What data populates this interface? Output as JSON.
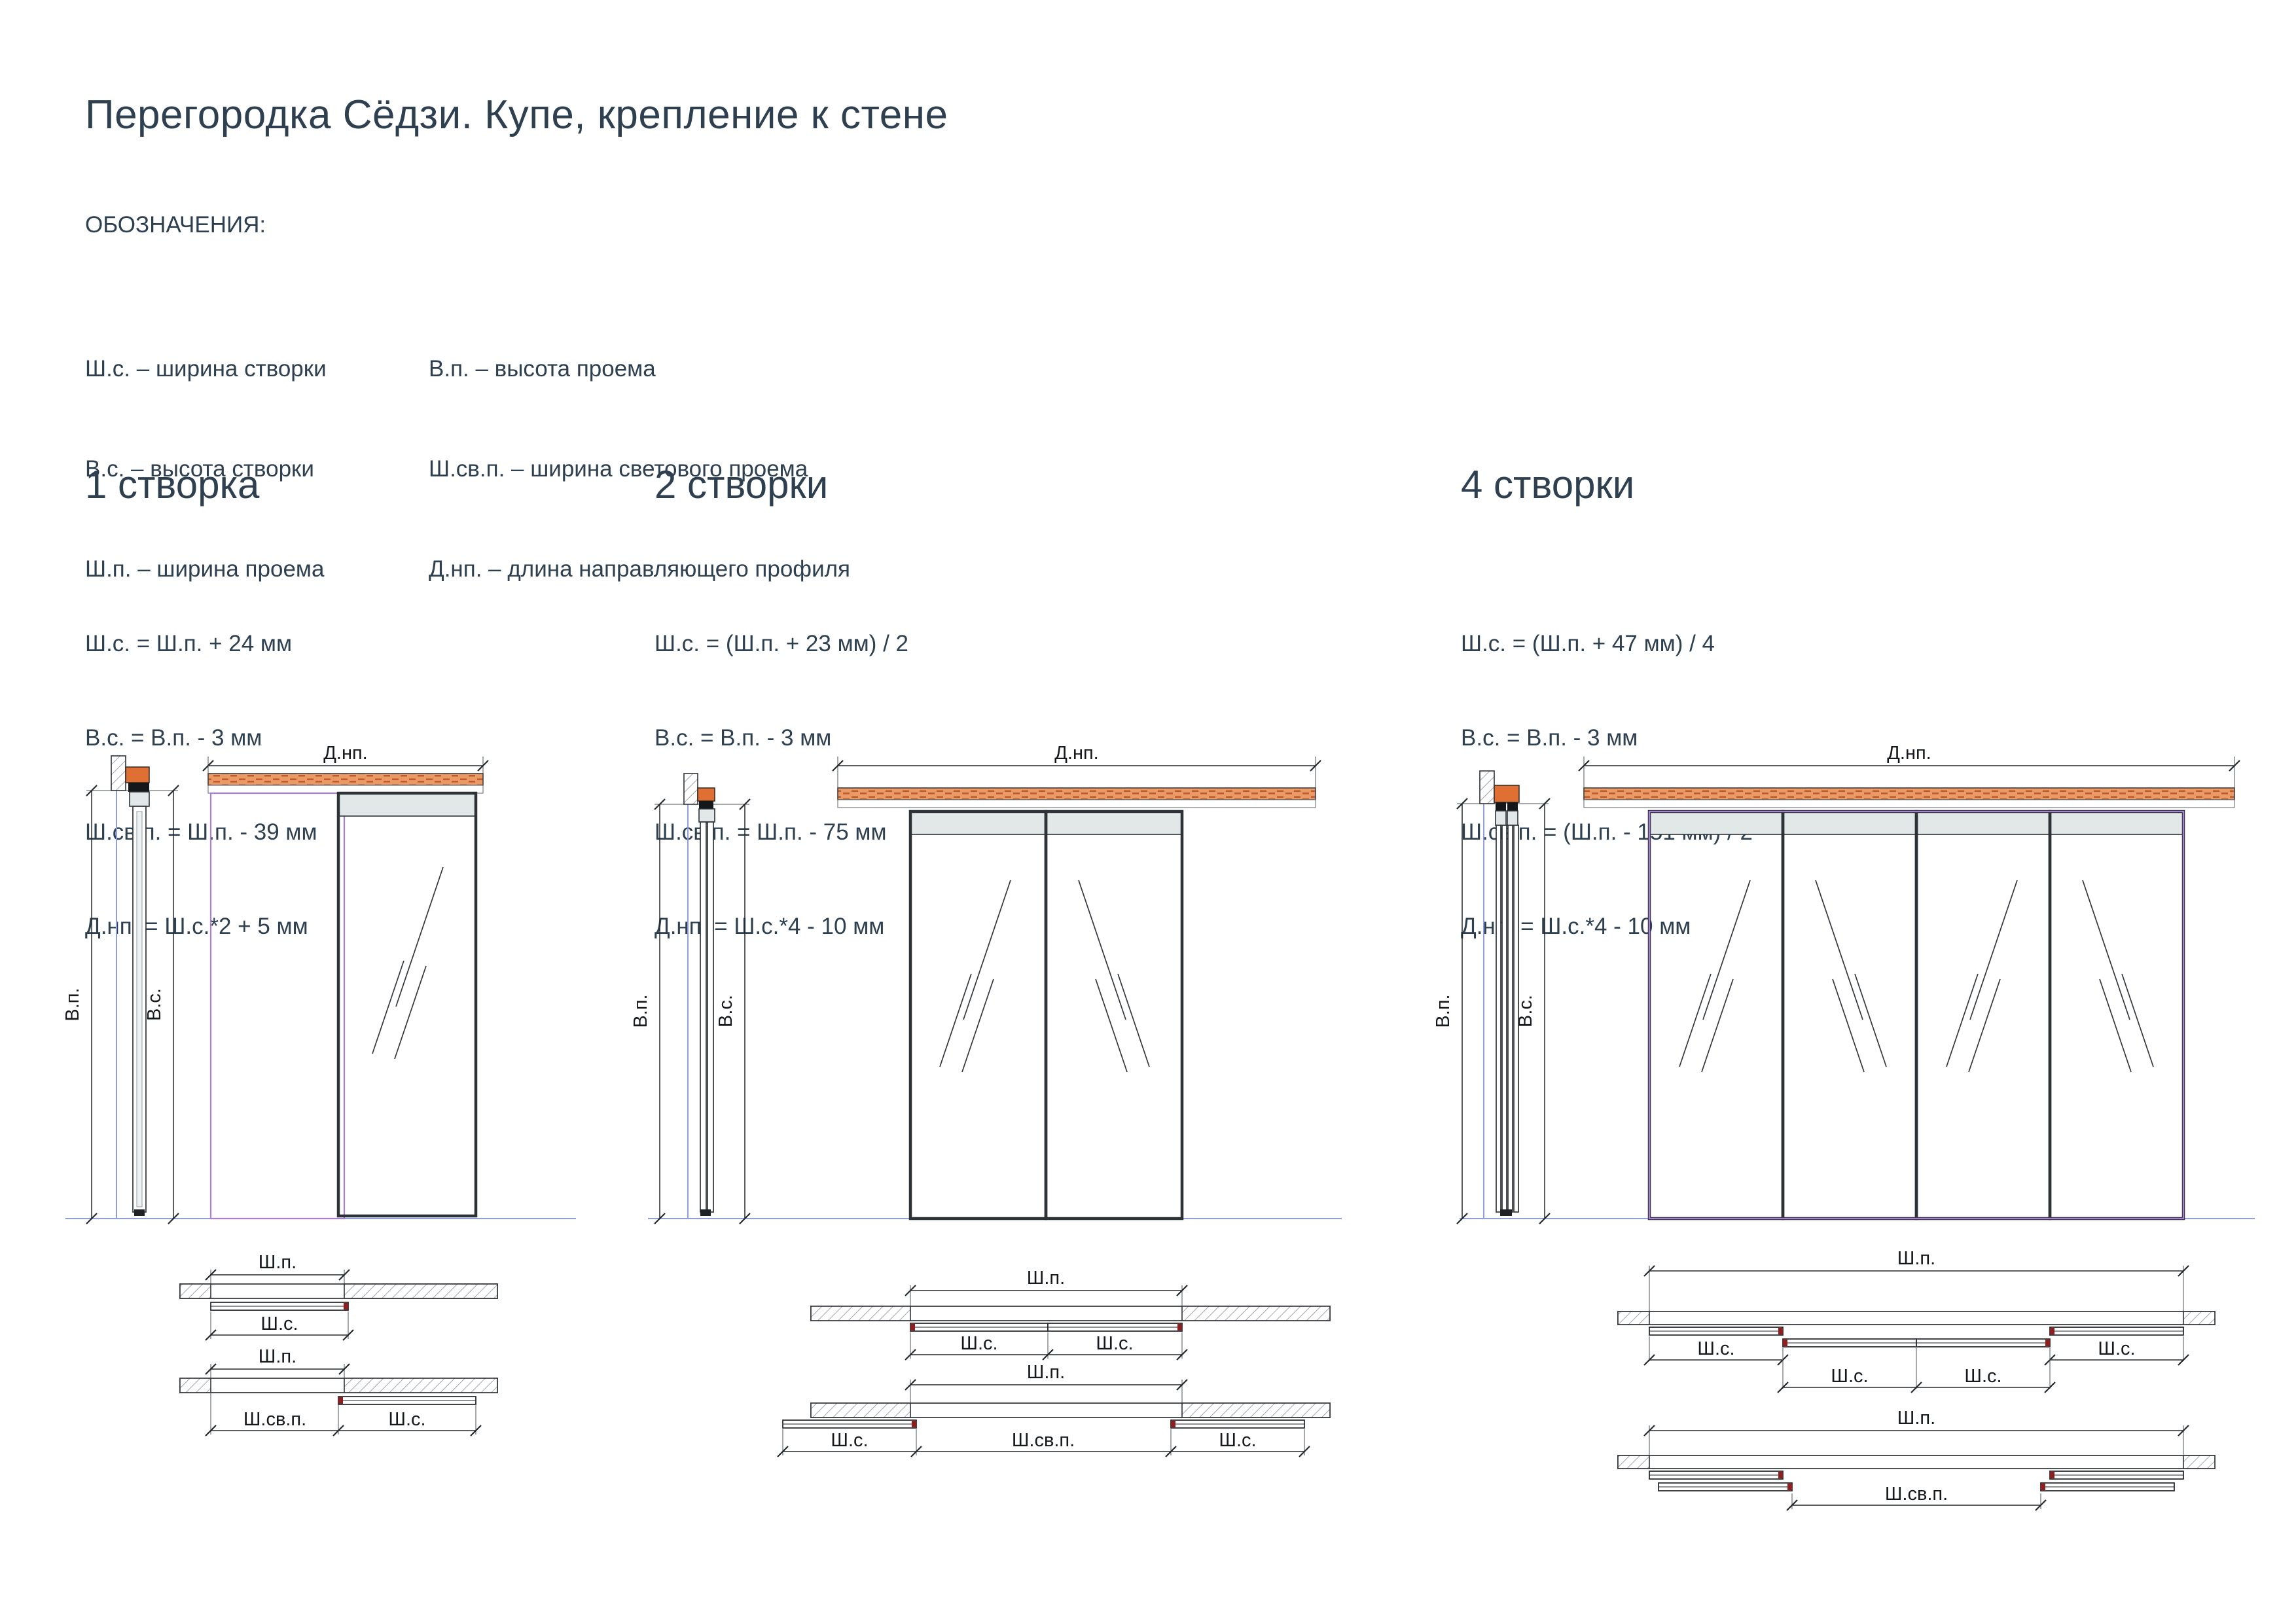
{
  "page": {
    "title": "Перегородка Сёдзи. Купе, крепление к стене"
  },
  "legend": {
    "heading": "ОБОЗНАЧЕНИЯ:",
    "col1": [
      "Ш.с. – ширина створки",
      "В.с. – высота створки",
      "Ш.п. – ширина проема"
    ],
    "col2": [
      "В.п. – высота проема",
      "Ш.св.п. – ширина светового проема",
      "Д.нп. – длина направляющего профиля"
    ]
  },
  "sections": [
    {
      "heading": "1 створка",
      "formulas": [
        "Ш.с. = Ш.п. + 24 мм",
        "В.с. = В.п. - 3 мм",
        "Ш.св.п. = Ш.п. - 39 мм",
        "Д.нп. = Ш.с.*2 + 5 мм"
      ]
    },
    {
      "heading": "2 створки",
      "formulas": [
        "Ш.с. = (Ш.п. + 23 мм) / 2",
        "В.с. = В.п. - 3 мм",
        "Ш.св.п. = Ш.п. - 75 мм",
        "Д.нп. = Ш.с.*4 - 10 мм"
      ]
    },
    {
      "heading": "4 створки",
      "formulas": [
        "Ш.с. = (Ш.п. + 47 мм) / 4",
        "В.с. = В.п. - 3 мм",
        "Ш.св.п. = (Ш.п. - 151 мм) / 2",
        "Д.нп. = Ш.с.*4 - 10 мм"
      ]
    }
  ],
  "drawing_labels": {
    "dnp": "Д.нп.",
    "vp": "В.п.",
    "vs": "В.с.",
    "shp": "Ш.п.",
    "shs": "Ш.с.",
    "shsvp": "Ш.св.п."
  },
  "colors": {
    "text": "#2e4050",
    "track_orange": "#eb9a66",
    "brick_dash": "#bf5b2d",
    "side_bracket_orange": "#df6f33",
    "opening_outline_purple": "#a97fd6",
    "floor_blue": "#8f9ce8",
    "leaf_frame": "#2d3237",
    "top_rail_gray": "#e2e8e8",
    "handle_red": "#8f1f1f"
  }
}
